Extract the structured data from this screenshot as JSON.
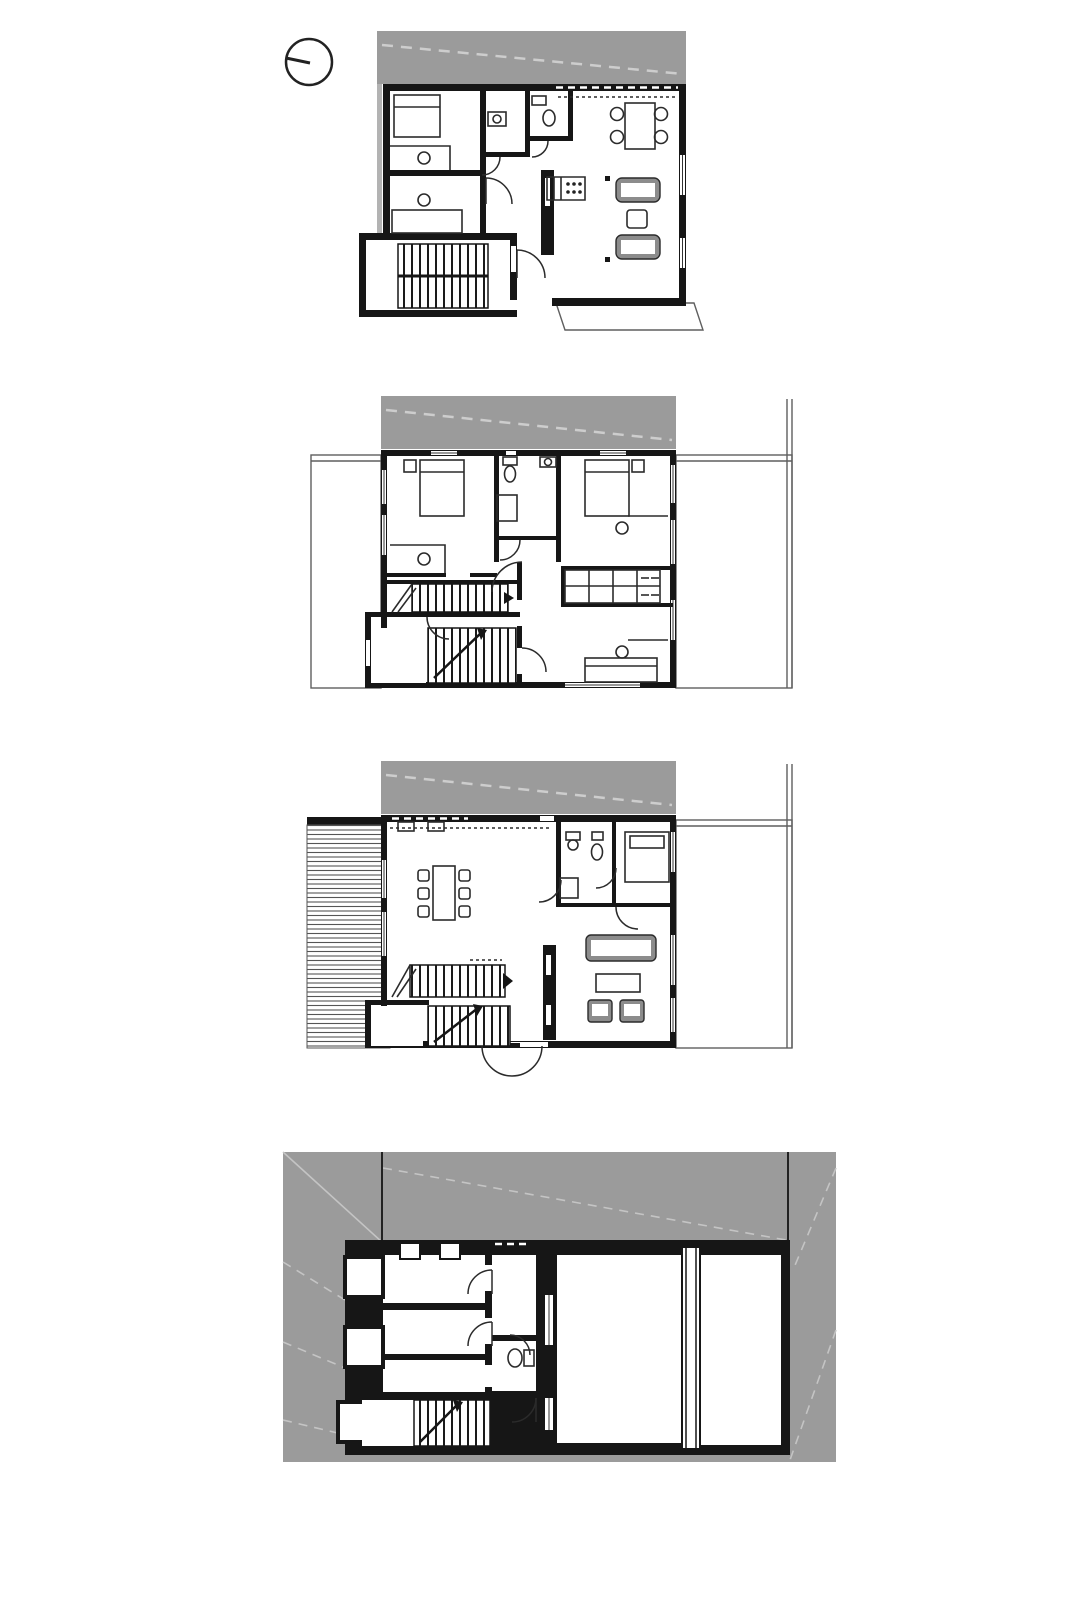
{
  "sheet": {
    "background": "#ffffff",
    "plan_count": 4
  },
  "colors": {
    "neighbor_roof_gray": "#9b9b9b",
    "site_ground_gray": "#9b9b9b",
    "wall_black": "#161616",
    "neighbor_wall_strip_gray": "#b3b3b3",
    "sofa_shade_gray": "#8c8c8c",
    "light_dash_gray": "#cdcdcd",
    "thin_outline_gray": "#5f5f5f"
  },
  "north_indicator": {
    "icon": "north-arrow-icon"
  },
  "plans": [
    {
      "id": "attic-floor-plan",
      "features": [
        "neighbor-roof-band",
        "bedroom-1",
        "bedroom-2",
        "bathroom",
        "wc",
        "kitchen-counter",
        "dining-table-4-chairs",
        "sofa-pair",
        "coffee-table",
        "stair-down-symbol",
        "main-staircase",
        "entry-step",
        "window-openings"
      ]
    },
    {
      "id": "upper-floor-plan",
      "features": [
        "neighbor-roof-band",
        "neighbor-outline-left",
        "neighbor-outline-right",
        "bedroom-left",
        "bedroom-right",
        "bathroom-wc",
        "wardrobe-grid",
        "desks-with-chairs",
        "bench-bed",
        "main-staircase",
        "vestibule-staircase",
        "door-swings"
      ]
    },
    {
      "id": "ground-floor-plan",
      "features": [
        "neighbor-roof-band",
        "neighbor-outline-right",
        "terrace-decking",
        "kitchen-counter",
        "dining-table-6-chairs",
        "bathroom",
        "rear-room-bed",
        "sofa",
        "coffee-table",
        "armchairs",
        "chimney-core",
        "main-staircase",
        "vestibule-staircase",
        "entry-door-swing"
      ]
    },
    {
      "id": "basement-floor-plan",
      "features": [
        "surrounding-ground",
        "site-boundary-lines",
        "light-wells",
        "cellar-room-1",
        "cellar-room-2",
        "cellar-room-3",
        "corridor",
        "wc-toilet",
        "large-storage-room-a",
        "large-storage-room-b",
        "party-wall-double-line",
        "staircase",
        "door-swings"
      ]
    }
  ]
}
